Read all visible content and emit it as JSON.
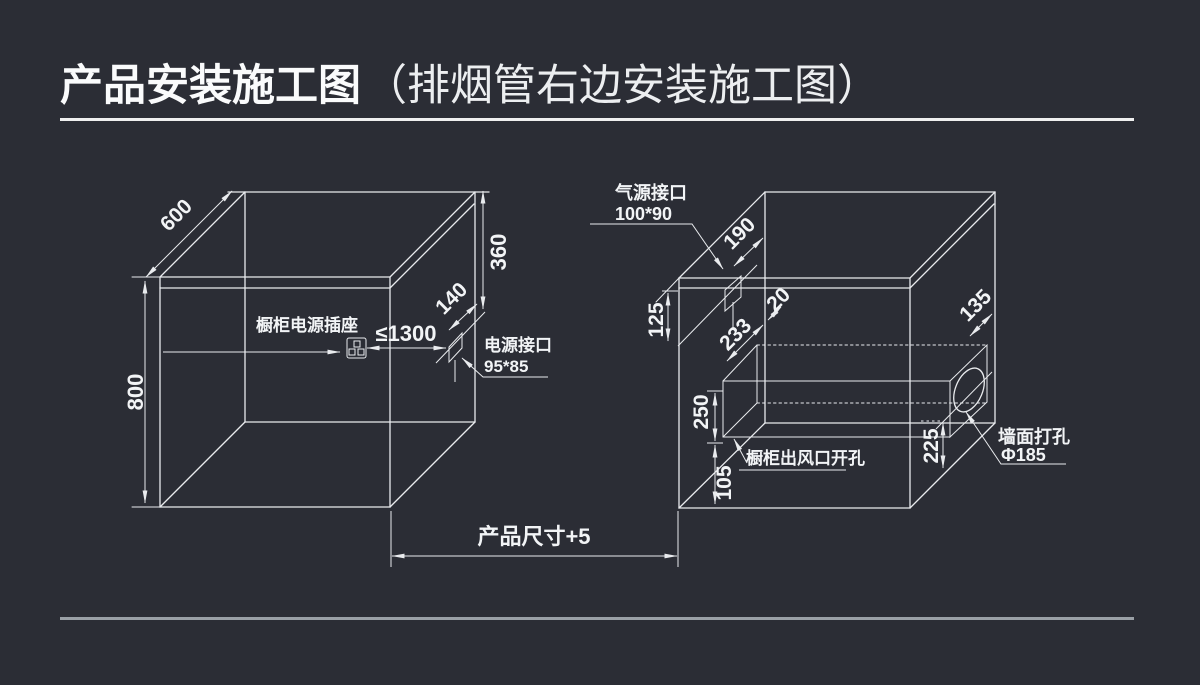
{
  "title": {
    "main": "产品安装施工图",
    "sub": "（排烟管右边安装施工图）"
  },
  "colors": {
    "background": "#2b2d35",
    "line": "#e9ebee",
    "text": "#f2f4f6",
    "title_underline": "#efefef",
    "footer_divider": "#9aa0a6"
  },
  "left_cabinet": {
    "depth": "600",
    "height": "800",
    "port_drop": "360",
    "port_offset": "140",
    "socket_label": "橱柜电源插座",
    "socket_distance": "≤1300",
    "power_port_label": "电源接口",
    "power_port_size": "95*85"
  },
  "right_cabinet": {
    "gas_port_label": "气源接口",
    "gas_port_size": "100*90",
    "gas_port_depth": "190",
    "top_clearance": "125",
    "duct_depth": "233",
    "duct_gap": "20",
    "duct_drop": "250",
    "duct_bottom_gap": "105",
    "vent_label": "橱柜出风口开孔",
    "hole_height": "225",
    "hole_depth": "135",
    "wall_hole_label": "墙面打孔",
    "wall_hole_size": "Φ185"
  },
  "footer_dim": {
    "label": "产品尺寸+5"
  }
}
